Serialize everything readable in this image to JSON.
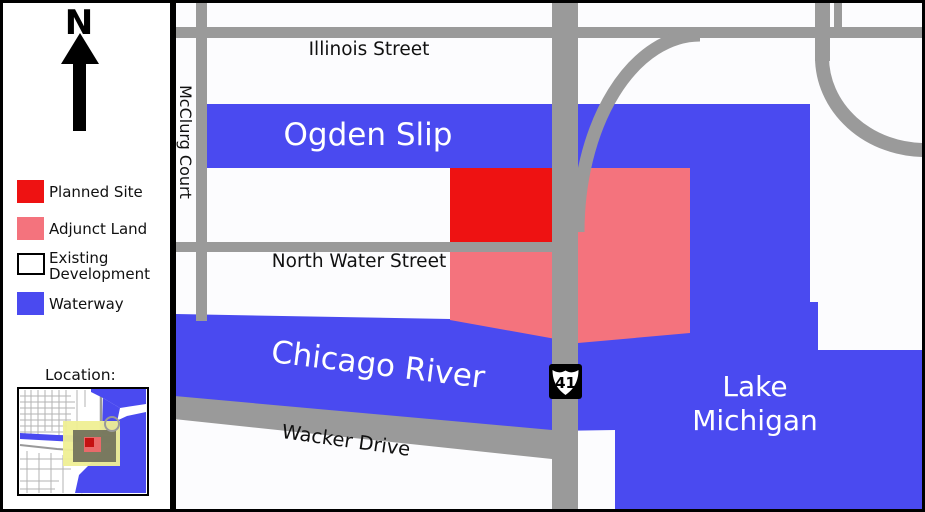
{
  "colors": {
    "waterway": "#4A4AF0",
    "planned_site": "#EE1212",
    "adjunct_land": "#F4737D",
    "street_gray": "#9A9A9A",
    "map_bg": "#FCFCFE",
    "panel_bg": "#FFFFFF",
    "inset_highlight_yellow": "#EFEF94",
    "inset_overlay_olive": "#70705A",
    "inset_marker_red": "#E96A6A",
    "inset_marker_dark_red": "#C41212"
  },
  "sidebar": {
    "north_label": "N",
    "legend": [
      {
        "label": "Planned Site"
      },
      {
        "label": "Adjunct Land"
      },
      {
        "label_line1": "Existing",
        "label_line2": "Development"
      },
      {
        "label": "Waterway"
      }
    ],
    "location_label": "Location:"
  },
  "map": {
    "street_labels": {
      "illinois": "Illinois Street",
      "mcclurg": "McClurg Court",
      "north_water": "North Water Street",
      "wacker": "Wacker Drive"
    },
    "water_labels": {
      "ogden_slip": "Ogden Slip",
      "chicago_river": "Chicago River",
      "lake_line1": "Lake",
      "lake_line2": "Michigan"
    },
    "route_shield": {
      "number": "41"
    }
  }
}
